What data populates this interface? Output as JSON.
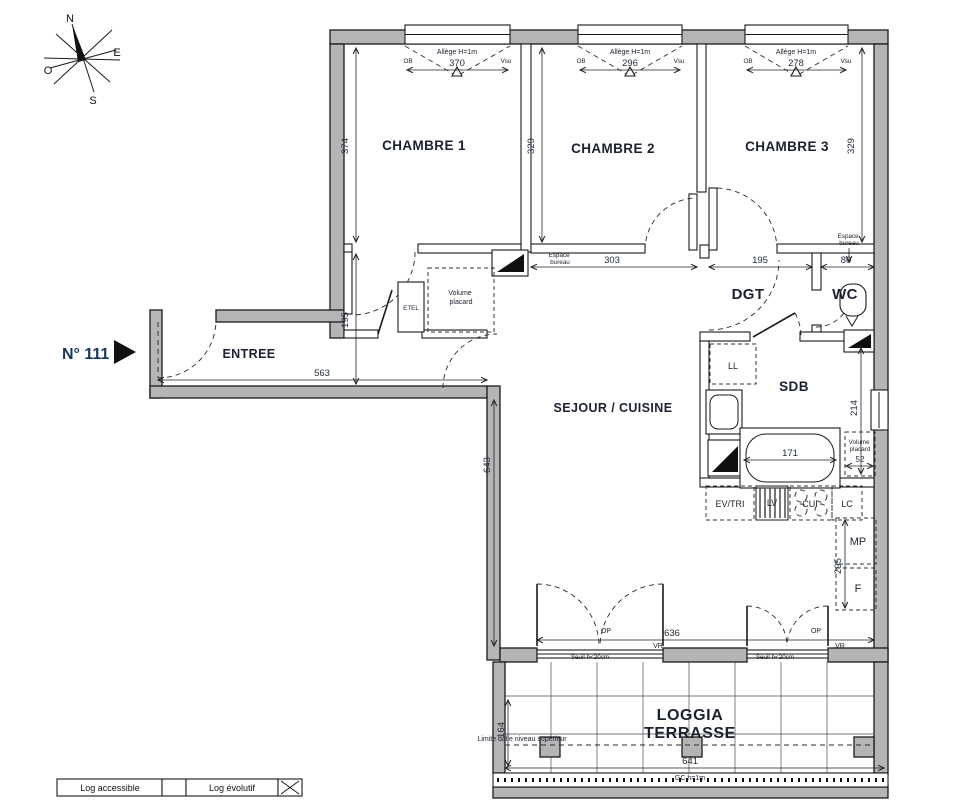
{
  "colors": {
    "wall_gray": "#b5b5b5",
    "line": "#1a1a1a",
    "unit_navy": "#17365d",
    "label": "#1b2130"
  },
  "unit": {
    "number": "N° 111"
  },
  "compass": {
    "n": "N",
    "e": "E",
    "s": "S",
    "o": "O"
  },
  "rooms": {
    "chambre1": "CHAMBRE 1",
    "chambre2": "CHAMBRE 2",
    "chambre3": "CHAMBRE 3",
    "entree": "ENTREE",
    "sejour": "SEJOUR / CUISINE",
    "dgt": "DGT",
    "wc": "WC",
    "sdb": "SDB",
    "loggia_l1": "LOGGIA",
    "loggia_l2": "TERRASSE"
  },
  "dimensions": {
    "win1": "370",
    "win2": "296",
    "win3": "278",
    "ch1_h": "374",
    "ch2_h": "329",
    "ch3_h": "329",
    "corridor": "303",
    "dgt_w": "195",
    "wc_w": "80",
    "entree_w": "563",
    "entree_h": "195",
    "sejour_h": "643",
    "sejour_w": "636",
    "loggia_w": "641",
    "loggia_h": "164",
    "sdb_h": "214",
    "bath_w": "171",
    "placard_w": "52",
    "kitchen_col": "295"
  },
  "windows": {
    "allege": "Allège H=1m",
    "ob": "OB",
    "vsu": "Vsu"
  },
  "annotations": {
    "espace_l1": "Espace",
    "espace_l2": "bureau",
    "etel": "ETEL",
    "volume_l1": "Volume",
    "volume_l2": "placard",
    "ll": "LL",
    "ev_tri": "EV/TRI",
    "lv": "LV",
    "cui": "CUI",
    "lc": "LC",
    "mp": "MP",
    "f": "F",
    "op": "OP",
    "vr": "VR",
    "seuil": "Seuil h<20cm",
    "limite": "Limite dalle niveau supérieur",
    "gc": "GC h=1m"
  },
  "legend": {
    "accessible": "Log accessible",
    "evolutif": "Log évolutif"
  }
}
